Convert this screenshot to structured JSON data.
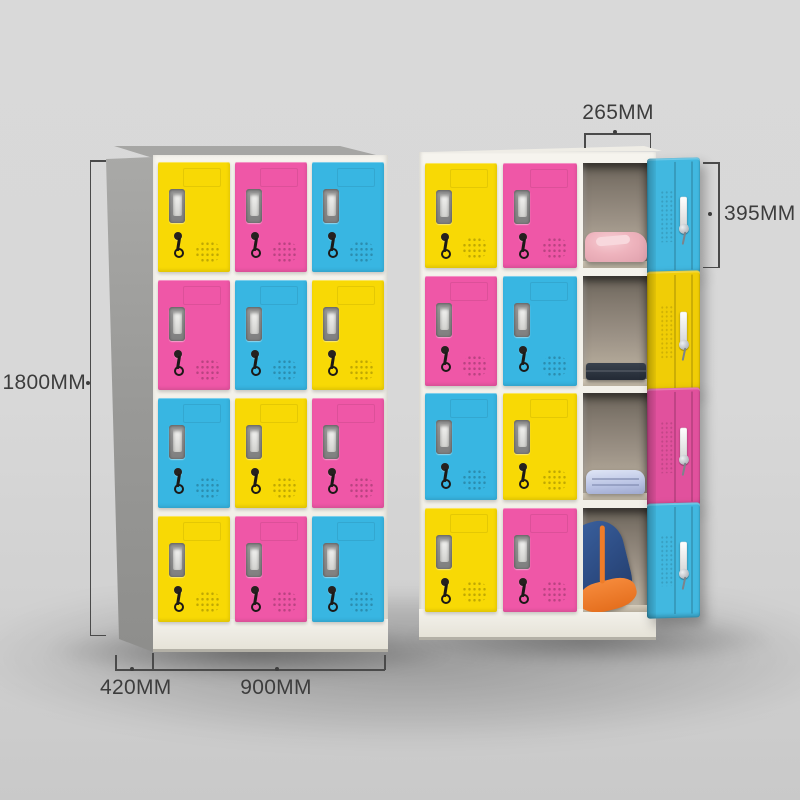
{
  "annotations": {
    "height_label": "1800MM",
    "depth_label": "420MM",
    "width_label": "900MM",
    "door_width_label": "265MM",
    "door_height_label": "395MM"
  },
  "palette": {
    "door_yellow": "#f8d905",
    "door_pink": "#ef57a7",
    "door_blue": "#38b6e2",
    "open_door_yellow": "#f0cd06",
    "open_door_pink": "#e1519d",
    "open_door_blue": "#41b8e0",
    "frame_white": "#f3f1ea",
    "side_gray": "#9d9d9b",
    "background_gray": "#d7d7d7",
    "annotation_text": "#3d3d3d"
  },
  "left_locker": {
    "description": "12-door locker, all doors closed",
    "door_colors_by_row": [
      [
        "yellow",
        "pink",
        "blue"
      ],
      [
        "pink",
        "blue",
        "yellow"
      ],
      [
        "blue",
        "yellow",
        "pink"
      ],
      [
        "yellow",
        "pink",
        "blue"
      ]
    ]
  },
  "right_locker": {
    "description": "12-door locker, right column doors open showing contents",
    "door_colors_by_row": [
      [
        "yellow",
        "pink",
        "blue-open"
      ],
      [
        "pink",
        "blue",
        "yellow-open"
      ],
      [
        "blue",
        "yellow",
        "pink-open"
      ],
      [
        "yellow",
        "pink",
        "blue-open"
      ]
    ],
    "open_compartment_contents": [
      "pink-clothes",
      "navy-clothes",
      "lavender-clothes",
      "blue-orange-backpack"
    ]
  }
}
